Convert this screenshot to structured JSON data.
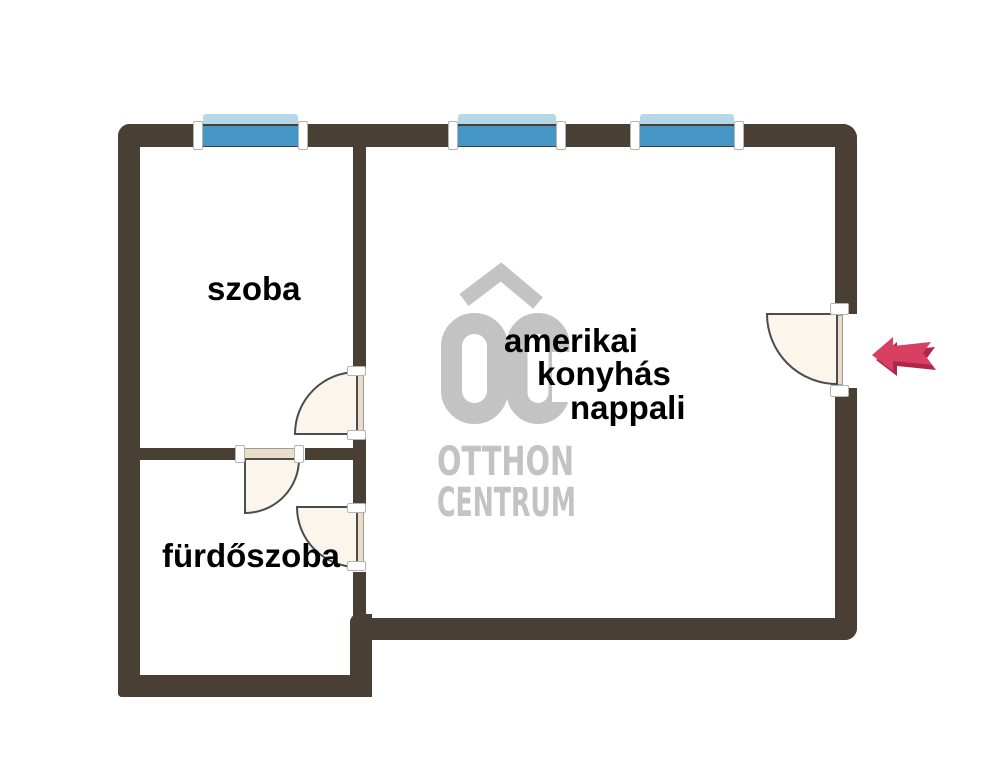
{
  "floorplan": {
    "rooms": {
      "szoba": {
        "label": "szoba"
      },
      "furdoszoba": {
        "label": "fürdőszoba"
      },
      "nappali": {
        "lines": [
          "amerikai",
          "konyhás",
          "nappali"
        ]
      }
    },
    "watermark": {
      "monogram": "OC",
      "line1": "OTTHON",
      "line2": "CENTRUM"
    },
    "entrance": {
      "direction": "left"
    },
    "counts": {
      "windows": 3,
      "doors": 4
    },
    "colors": {
      "canvas_bg": "#ffffff",
      "wall": "#4a3f35",
      "window_blue": "#4596c4",
      "window_sill": "#b7d7e6",
      "door_fill": "#fbf5eb",
      "door_leaf": "#e9ddca",
      "door_stroke": "#4c4c4c",
      "bracket_border": "#b4b4b4",
      "arrow_main": "#d84061",
      "arrow_shadow": "#b2254a",
      "logo_gray": "#c3c3c3",
      "label": "#000000"
    }
  }
}
